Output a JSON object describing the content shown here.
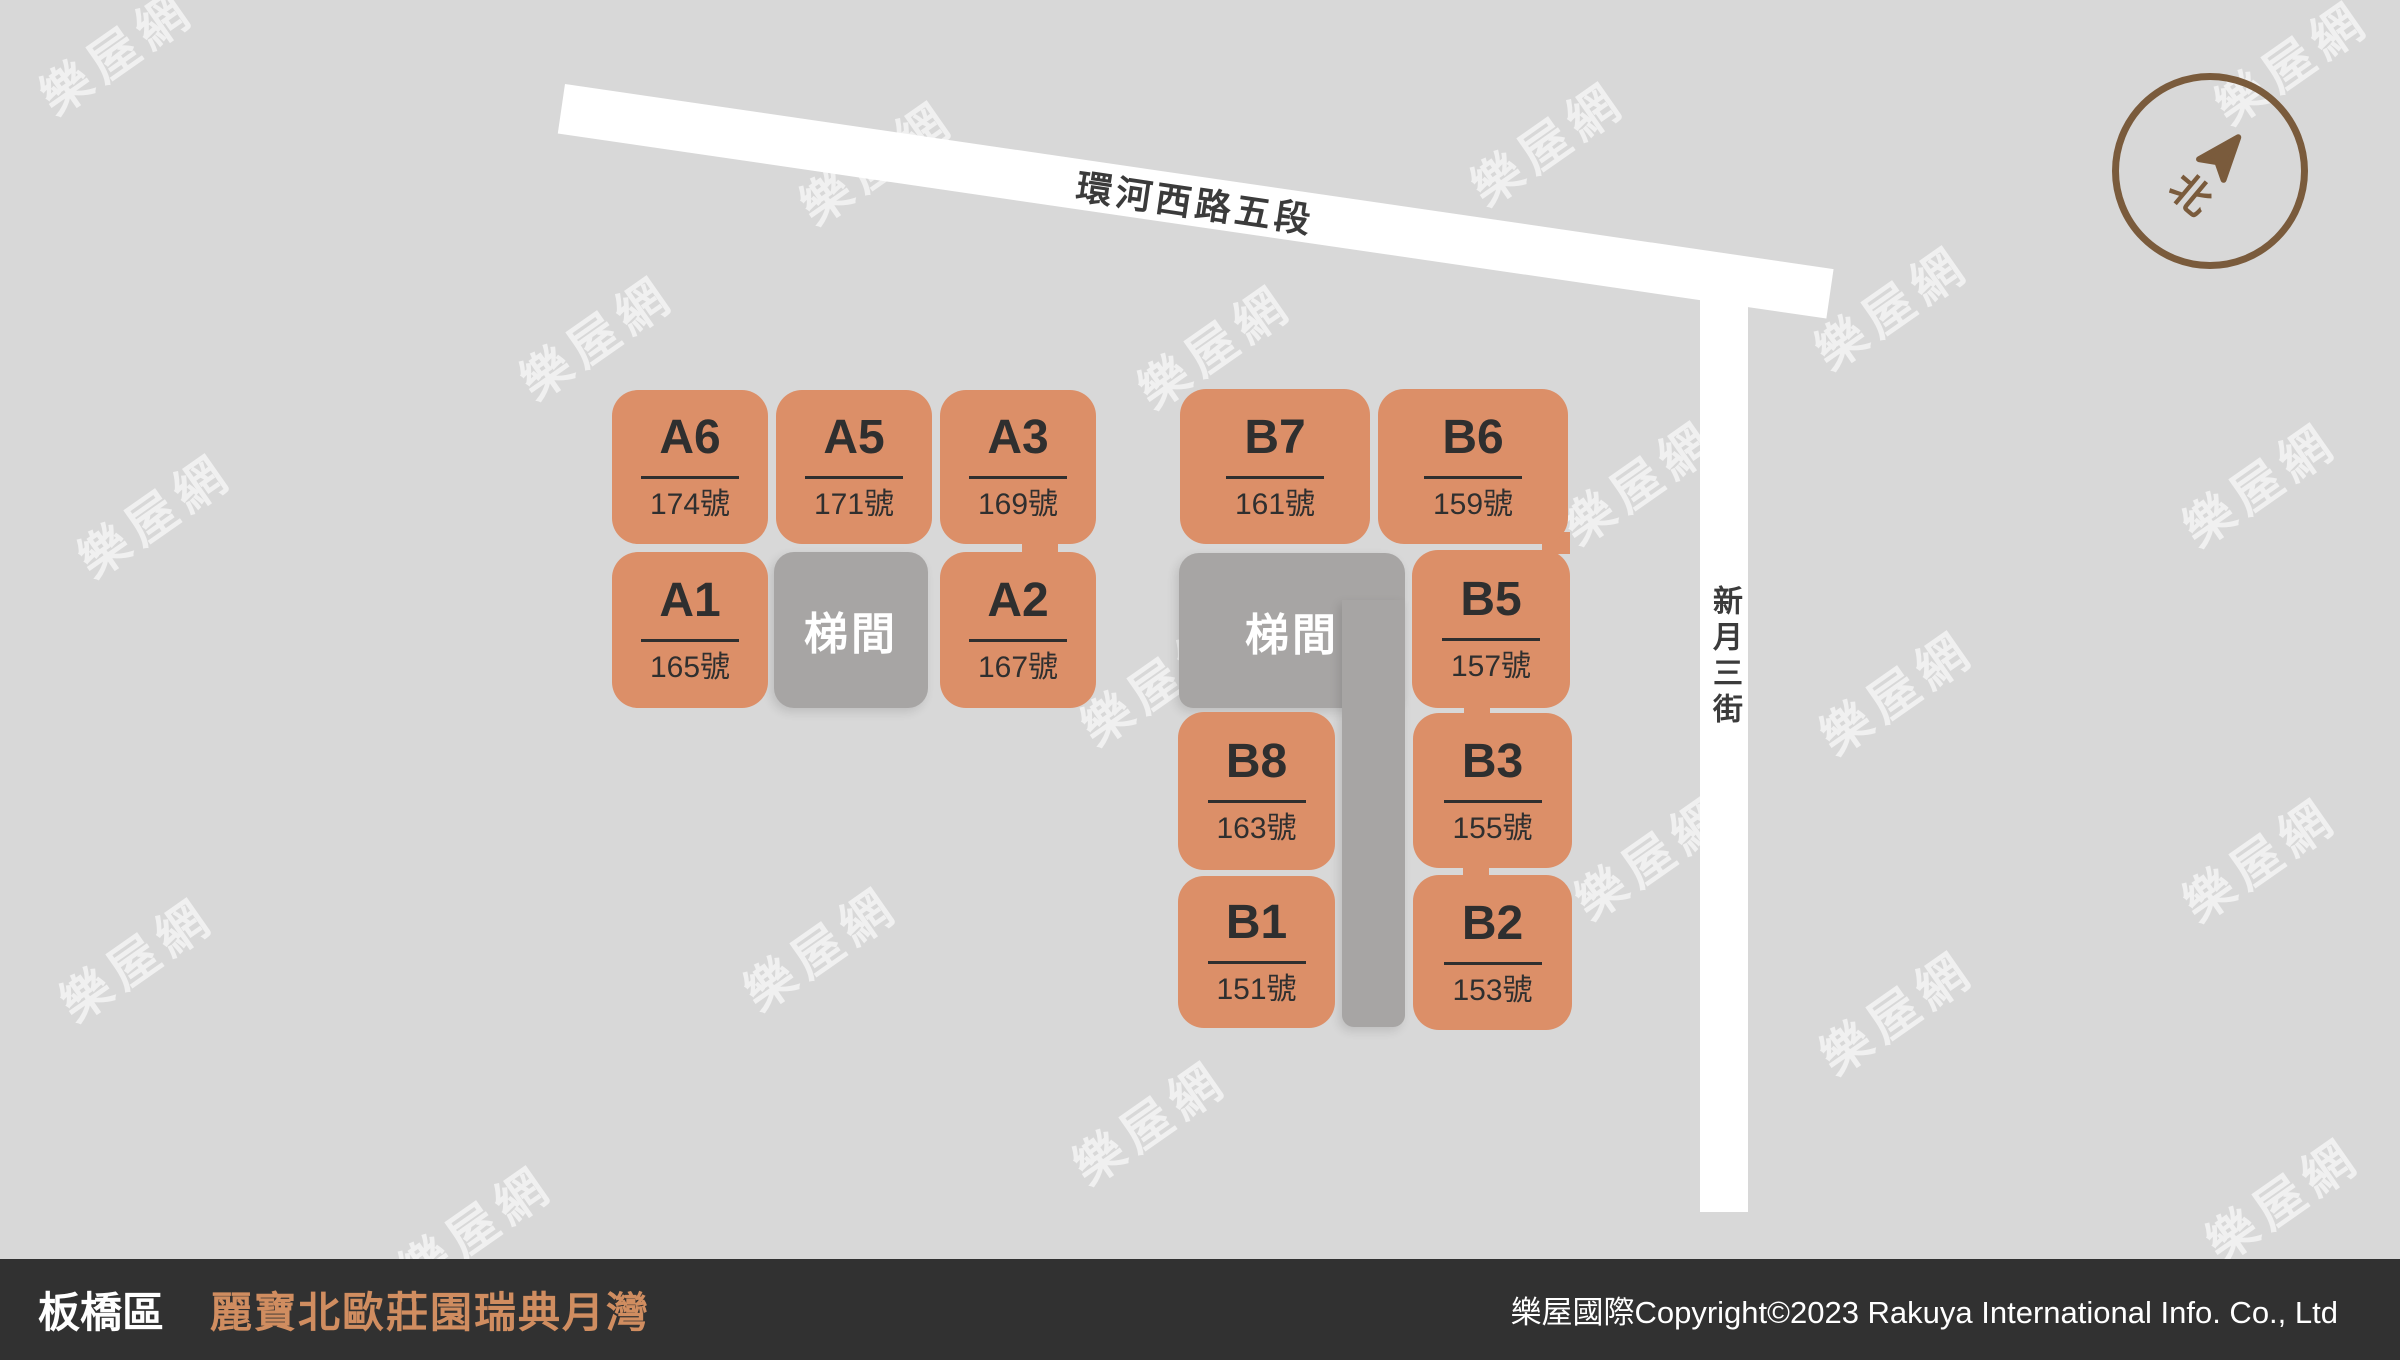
{
  "map": {
    "roads": {
      "horizontal_label": "環河西路五段",
      "vertical_label": "新月三街"
    },
    "compass_label": "北",
    "stairwell_label": "梯間",
    "group_a": {
      "blocks": [
        {
          "label": "A6",
          "number": "174號"
        },
        {
          "label": "A5",
          "number": "171號"
        },
        {
          "label": "A3",
          "number": "169號"
        },
        {
          "label": "A1",
          "number": "165號"
        },
        {
          "label": "A2",
          "number": "167號"
        }
      ]
    },
    "group_b": {
      "blocks": [
        {
          "label": "B7",
          "number": "161號"
        },
        {
          "label": "B6",
          "number": "159號"
        },
        {
          "label": "B5",
          "number": "157號"
        },
        {
          "label": "B8",
          "number": "163號"
        },
        {
          "label": "B3",
          "number": "155號"
        },
        {
          "label": "B1",
          "number": "151號"
        },
        {
          "label": "B2",
          "number": "153號"
        }
      ]
    }
  },
  "watermark": {
    "text": "樂屋網"
  },
  "footer": {
    "district": "板橋區",
    "project_name": "麗寶北歐莊園瑞典月灣",
    "copyright": "樂屋國際Copyright©2023 Rakuya International Info. Co., Ltd"
  },
  "colors": {
    "background": "#d8d8d8",
    "unit_block": "#dc8f68",
    "stairwell": "#a7a5a4",
    "road": "#ffffff",
    "footer_background": "#313131",
    "footer_accent": "#d08d60",
    "compass": "#7a5b3c"
  }
}
